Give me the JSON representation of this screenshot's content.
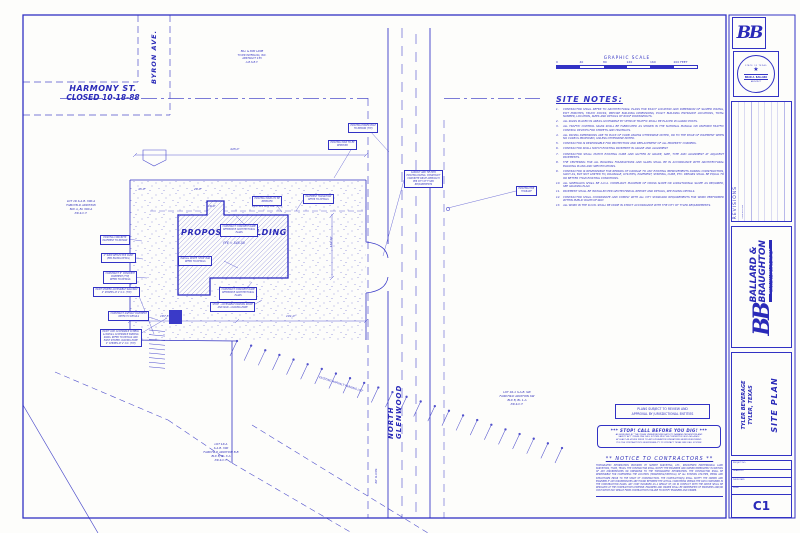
{
  "streets": {
    "harmony": {
      "line1": "HARMONY ST.",
      "line2": "CLOSED 10-18-88"
    },
    "byron": "BYRON AVE.",
    "glenwood": "NORTH GLENWOOD"
  },
  "owner_note": [
    "BILL & PAM LAMB",
    "TYLER INTERLOG, INC.",
    "ABSTRACT 155",
    "A.B.S.B.T."
  ],
  "graphic_scale": {
    "title": "GRAPHIC SCALE",
    "ticks": [
      "0",
      "40",
      "80",
      "120",
      "160",
      "200 FEET"
    ]
  },
  "site_notes": {
    "title": "SITE NOTES:",
    "items": [
      "CONTRACTOR SHALL REFER TO ARCHITECTURAL PLANS FOR EXACT LOCATION AND DIMENSION OF SLOPED PAVING, EXIT PORCHES, TRUCK DOCKS, PRECISE BUILDING DIMENSIONS, EXACT BUILDING ENTRANCE LOCATIONS, TOTAL NUMBER, LOCATION, SIZES AND DETAILS OF ROOF DOWNSPOUTS.",
      "ALL SIGNS PLACED IN AREAS ACCESSIBLE BY VEHICLE TRAFFIC SHALL BE PLACED IN GUARD POSTS.",
      "ALL TRAFFIC CONTROL SIGNS SHALL BE FABRICATED AS SHOWN IN THE NATIONAL MANUAL ON UNIFORM TRAFFIC CONTROL DEVICES FOR STREETS AND HIGHWAYS.",
      "ALL PAVING DIMENSIONS ARE TO BACK OF CURB UNLESS OTHERWISE NOTED, OR TO THE EDGE OF PAVEMENT WHEN NO CURB IS PROPOSED, UNLESS OTHERWISE NOTED.",
      "CONTRACTOR IS RESPONSIBLE FOR PROTECTION AND REPLACEMENT OF ALL PROPERTY CORNERS.",
      "CONTRACTOR SHALL MATCH EXISTING PAVEMENT IN GRADE AND ALIGNMENT.",
      "CONTRACTOR SHALL MATCH EXISTING CURB AND GUTTER IN GRADE, SIZE, TYPE AND ALIGNMENT AT ADJACENT PAVEMENTS.",
      "THE CENTERING FOR ALL BUILDING FOUNDATIONS AND SLABS SHALL BE IN ACCORDANCE WITH ARCHITECTURAL BUILDING PLANS AND SPECIFICATIONS.",
      "CONTRACTOR IS RESPONSIBLE FOR REPAIRS OF DAMAGE TO ANY EXISTING IMPROVEMENTS DURING CONSTRUCTION, SUCH AS, BUT NOT LIMITED TO, DRAINAGE, UTILITIES, PAVEMENT, STRIPING, CURB, ETC. REPAIRS SHALL BE EQUAL TO OR BETTER THAN EXISTING CONDITIONS.",
      "ALL SIDEWALKS SHALL BE A.D.A. COMPLIANT. MAXIMUM OF CROSS SLOPE OR LONGITUDINAL SLOPE AS REQUIRED, SEE GRADING PLAN.",
      "PAVEMENT SHALL BE INSTALLED PER GEOTECHNICAL REPORT AND DETAILS, SEE PAVING DETAILS.",
      "CONTRACTOR SHALL COORDINATE AND COMPLY WITH ALL CITY STANDARD REQUIREMENTS FOR WORK PERFORMED WITHIN PUBLIC RIGHT-OF-WAY.",
      "ALL WORK IN THE R.O.W. SHALL BE DONE IN STRICT ACCORDANCE WITH THE CITY OF TYLER REQUIREMENTS."
    ]
  },
  "building": {
    "label": "PROPOSED BUILDING",
    "ffe": "FFE  =  548.50"
  },
  "labels": {
    "gas_line": "EXISTING GAS LINE (TYP)",
    "parking_lot": "EXISTING ASPHALT PARKING LOT"
  },
  "lots": [
    {
      "x": 42,
      "y": 199,
      "lines": [
        "LOT 1R  S.A.B.  300-A",
        "FAIRCHILD ADDITION",
        "BLK A, BL 300-A",
        "P.R.S.C.T."
      ]
    },
    {
      "x": 478,
      "y": 390,
      "lines": [
        "LOT 1R-1  S.A.B.  SW",
        "FAIRCHILD ADDITION SW",
        "BLK B, BL 1-A",
        "P.R.S.C.T."
      ]
    },
    {
      "x": 182,
      "y": 442,
      "lines": [
        "LOT 1R-A",
        "S.A.B.  300",
        "FAIRCHILD ADDITION B-B",
        "BLK B, BL 3-A",
        "P.R.S.C.T."
      ]
    }
  ],
  "dimensions": [
    {
      "t": "445.0'",
      "x": 230,
      "y": 147
    },
    {
      "t": "45.0'",
      "x": 138,
      "y": 187
    },
    {
      "t": "28.0'",
      "x": 194,
      "y": 187
    },
    {
      "t": "16.0'",
      "x": 208,
      "y": 204
    },
    {
      "t": "162.50'",
      "x": 329,
      "y": 236,
      "r": 1
    },
    {
      "t": "187.5'",
      "x": 160,
      "y": 314
    },
    {
      "t": "101.0'",
      "x": 286,
      "y": 314
    },
    {
      "t": "60' R.O.W.",
      "x": 374,
      "y": 468,
      "r": 1
    }
  ],
  "callouts": [
    {
      "x": 220,
      "y": 224,
      "l": [
        "CONSTRUCT CONCRETE RAMP",
        "REFERENCE ARCHITECTURAL",
        "PLANS"
      ]
    },
    {
      "x": 252,
      "y": 196,
      "l": [
        "EXISTING TANKS TO BE",
        "REMOVED"
      ]
    },
    {
      "x": 303,
      "y": 194,
      "l": [
        "PAVEMENT TRANSITION",
        "REFER TO DETAILS"
      ]
    },
    {
      "x": 178,
      "y": 256,
      "l": [
        "INSTALL WHITE 'STOP' BAR",
        "REFER TO DETAILS"
      ]
    },
    {
      "x": 219,
      "y": 287,
      "l": [
        "CONSTRUCT CONCRETE RAMP",
        "REFERENCE ARCHITECTURAL",
        "PLANS"
      ]
    },
    {
      "x": 210,
      "y": 302,
      "l": [
        "STOP! - ACCESSIBLE PARKING SPACE",
        "AND SIGN - LOADING ZONE"
      ]
    },
    {
      "x": 100,
      "y": 235,
      "l": [
        "EXISTING CONCRETE",
        "PAVEMENT TO REMAIN"
      ]
    },
    {
      "x": 101,
      "y": 253,
      "l": [
        "4\" WIDE REFLECTIVE PAINT",
        "(PER PAVING DETAIL)"
      ]
    },
    {
      "x": 103,
      "y": 271,
      "l": [
        "CONSTRUCT 6\" CONCRETE",
        "PAVEMENT (TYP)",
        "REFER TO DETAILS"
      ]
    },
    {
      "x": 93,
      "y": 287,
      "l": [
        "PAINT STRIPED ACCESSIBLE WALKWAY",
        "4\" STRIPES AT 2' O.C. (TYP)"
      ]
    },
    {
      "x": 108,
      "y": 311,
      "l": [
        "CONSTRUCT ASPHALT PAVEMENT",
        "REFER TO DETAILS"
      ]
    },
    {
      "x": 100,
      "y": 329,
      "l": [
        "PAINT 'VAN' ACCESSIBLE SYMBOL",
        "& INSTALL ACCESSIBLE PARKING",
        "SIGNS. REFER TO DETAILS AND",
        "PAINT STRIPED LOADING ZONE",
        "4\" STRIPES AT 2' O.C. (TYP)"
      ]
    },
    {
      "x": 404,
      "y": 170,
      "l": [
        "SAWCUT AND TIE INTO",
        "EXISTING PAVING. CONSTRUCT",
        "CONCRETE DRIVE APPROACH",
        "PER CITY OF TYLER",
        "REQUIREMENTS"
      ]
    },
    {
      "x": 328,
      "y": 140,
      "l": [
        "EXISTING TANK TO BE",
        "REMOVED"
      ]
    },
    {
      "x": 348,
      "y": 123,
      "l": [
        "EXISTING POWER POLE",
        "TO REMAIN (TYP)"
      ]
    },
    {
      "x": 516,
      "y": 186,
      "l": [
        "EXISTING FIRE",
        "HYDRANT"
      ]
    }
  ],
  "notices": {
    "review": [
      "PLANS SUBJECT TO REVIEW AND",
      "APPROVAL BY JURISDICTIONAL ENTITIES"
    ],
    "stop": {
      "title": "***   STOP!  CALL  BEFORE  YOU  DIG!   ***",
      "body": [
        "AS REQUIRED BY 'THE TEXAS UNDERGROUND FACILITY DAMAGE PREVENTION AND",
        "SAFETY ACT' TEXAS ONE CALL SYSTEM MUST BE CONTACTED (800-245-4545)",
        "AT LEAST 48 HOURS PRIOR TO ANY EXCAVATION OPERATIONS BEING PERFORMED.",
        "IT IS THE CONTRACTOR'S RESPONSIBILITY TO CONTACT TEXAS ONE CALL SYSTEM."
      ]
    },
    "contractors": {
      "title": "**    NOTICE  TO  CONTRACTORS    **",
      "body": "TOPOGRAPHIC INFORMATION PROVIDED BY SUMMIT SURVEYING, LTD., REGISTERED PROFESSIONAL LAND SURVEYORS, TYLER, TEXAS. THE CONTRACTOR SHALL NOTIFY THE ENGINEER AND OWNER IMMEDIATELY IN WRITING OF ANY DISCREPANCIES OR OMISSIONS TO THE TOPOGRAPHIC INFORMATION. THE CONTRACTOR SHALL BE RESPONSIBLE FOR CONFIRMING THE LOCATION (HORIZONTAL/VERTICAL) OF ALL EXISTING UTILITIES, PIPING AND STRUCTURES PRIOR TO THE START OF CONSTRUCTION. THE CONTRACTOR(S) SHALL NOTIFY THE OWNER AND ENGINEER IF ANY DISCREPANCIES ARE FOUND BETWEEN THE ACTUAL CONDITIONS VERSUS THE DATA CONTAINED IN THE CONSTRUCTION PLANS. ANY COST INCURRED AS A RESULT OF, OR IN CONFLICT WITH THE ABOVE SHALL BE RESOLVED AT THE CONTRACTOR'S EXPENSE. ENGINEER AND OWNER SHALL BE INDEMNIFIED OF PROBLEMS AND/OR COST WHICH MAY RESULT FROM CONTRACTOR'S FAILURE TO NOTIFY ENGINEER AND OWNER."
    }
  },
  "titleblock": {
    "logo": "BB",
    "seal": {
      "state": "STATE OF TEXAS",
      "star": "★",
      "name": "BRAD A. BALLARD",
      "title": "ARCHITECT"
    },
    "revisions": {
      "title": "REVISIONS",
      "col1": "DESCRIPTION"
    },
    "firm": {
      "name1": "BALLARD &",
      "name2": "BRAUGHTON",
      "tagline": "A R C H I T E C T U R E  •  I N T E R I O R S",
      "address": "OLD BULLARD ROAD  •  TYLER, TEXAS  •  TEL • FAX"
    },
    "project": {
      "name": "TYLER BEVERAGE",
      "city": "TYLER, TEXAS",
      "sheet": "SITE PLAN"
    },
    "fields": [
      "PROJECT NO.",
      "DRAWN BY",
      "ISSUE DATE",
      "SHEET"
    ],
    "sheet_number": "C1"
  },
  "colors": {
    "ink": "#3232c4",
    "lite": "#8f8fdd"
  }
}
